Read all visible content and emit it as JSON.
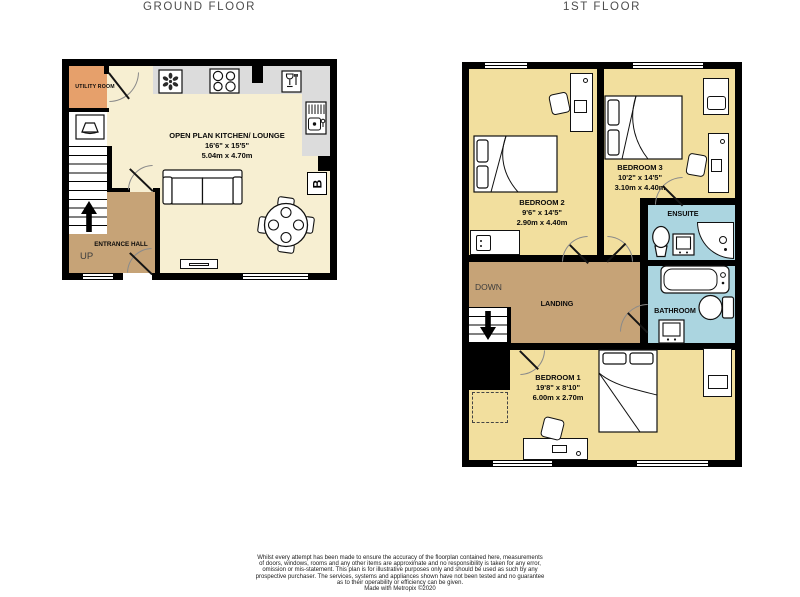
{
  "titles": {
    "ground": "GROUND FLOOR",
    "first": "1ST FLOOR"
  },
  "colors": {
    "walls": "#000000",
    "kitchen_floor": "#F7EFD2",
    "bedroom_floor": "#F2DF9E",
    "hall_landing_floor": "#C6A377",
    "utility_floor": "#E6A06B",
    "bathroom_floor": "#ABD5E0",
    "counter": "#DCDCDC"
  },
  "ground_floor": {
    "utility_room": {
      "name": "UTILITY ROOM"
    },
    "kitchen_lounge": {
      "name": "OPEN PLAN KITCHEN/ LOUNGE",
      "size_imperial": "16'6\" x 15'5\"",
      "size_metric": "5.04m x 4.70m"
    },
    "entrance_hall": {
      "name": "ENTRANCE HALL"
    },
    "stairs_label": "UP",
    "boiler_label": "B"
  },
  "first_floor": {
    "bedroom_2": {
      "name": "BEDROOM 2",
      "size_imperial": "9'6\" x 14'5\"",
      "size_metric": "2.90m x 4.40m"
    },
    "bedroom_3": {
      "name": "BEDROOM 3",
      "size_imperial": "10'2\" x 14'5\"",
      "size_metric": "3.10m x 4.40m"
    },
    "bedroom_1": {
      "name": "BEDROOM 1",
      "size_imperial": "19'8\" x 8'10\"",
      "size_metric": "6.00m x 2.70m"
    },
    "ensuite": {
      "name": "ENSUITE"
    },
    "bathroom": {
      "name": "BATHROOM"
    },
    "landing": {
      "name": "LANDING"
    },
    "stairs_label": "DOWN"
  },
  "footer": {
    "lines": [
      "Whilst every attempt has been made to ensure the accuracy of the floorplan contained here, measurements",
      "of doors, windows, rooms and any other items are approximate and no responsibility is taken for any error,",
      "omission or mis-statement. This plan is for illustrative purposes only and should be used as such by any",
      "prospective purchaser. The services, systems and appliances shown have not been tested and no guarantee",
      "as to their operability or efficiency can be given.",
      "Made with Metropix ©2020"
    ]
  }
}
